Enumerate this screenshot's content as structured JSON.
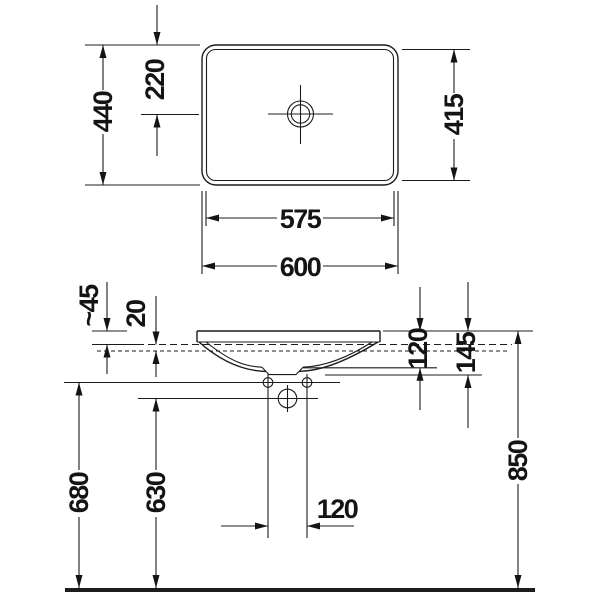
{
  "plan_view": {
    "outer_width": "600",
    "rim_width": "575",
    "outer_depth": "440",
    "tap_center_offset": "220",
    "rim_depth": "415"
  },
  "front_view": {
    "rim_above_counter": "~45",
    "counter_thickness": "20",
    "basin_inner_depth": "120",
    "basin_total_depth": "145",
    "hole_spacing": "120",
    "height_fixing_holes": "680",
    "height_drain": "630",
    "installation_height": "850"
  }
}
